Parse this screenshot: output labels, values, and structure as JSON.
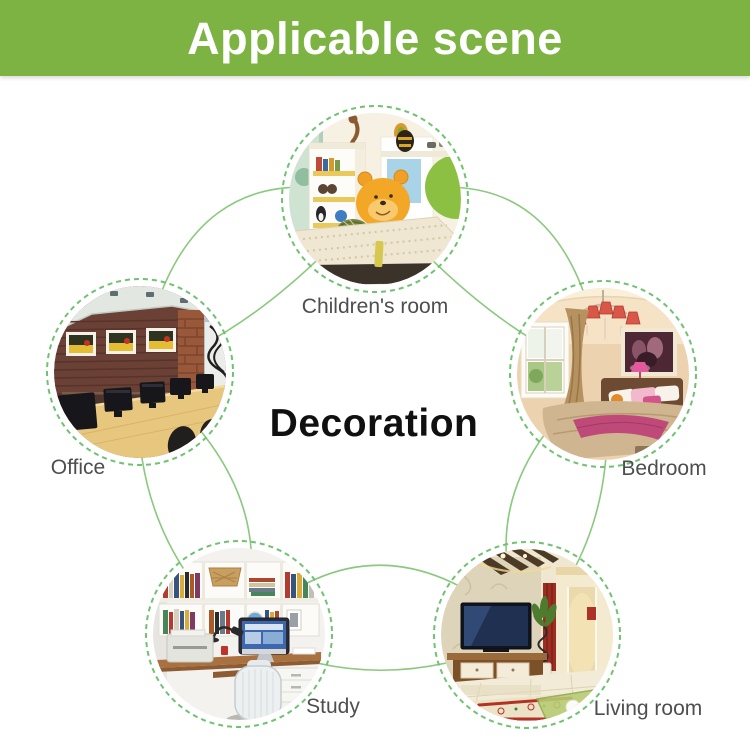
{
  "banner": {
    "title": "Applicable scene",
    "background_color": "#7cb342",
    "text_color": "#ffffff"
  },
  "center_label": "Decoration",
  "scenes": [
    {
      "id": "children-room",
      "label": "Children's room",
      "position": "top"
    },
    {
      "id": "office",
      "label": "Office",
      "position": "left"
    },
    {
      "id": "bedroom",
      "label": "Bedroom",
      "position": "right"
    },
    {
      "id": "study",
      "label": "Study",
      "position": "bottom-left"
    },
    {
      "id": "living-room",
      "label": "Living room",
      "position": "bottom-right"
    }
  ],
  "colors": {
    "connector_arc_green": "#8bc97e",
    "dashed_ring_green": "#6fc272",
    "label_gray": "#4e4e4e",
    "center_text": "#101010"
  }
}
